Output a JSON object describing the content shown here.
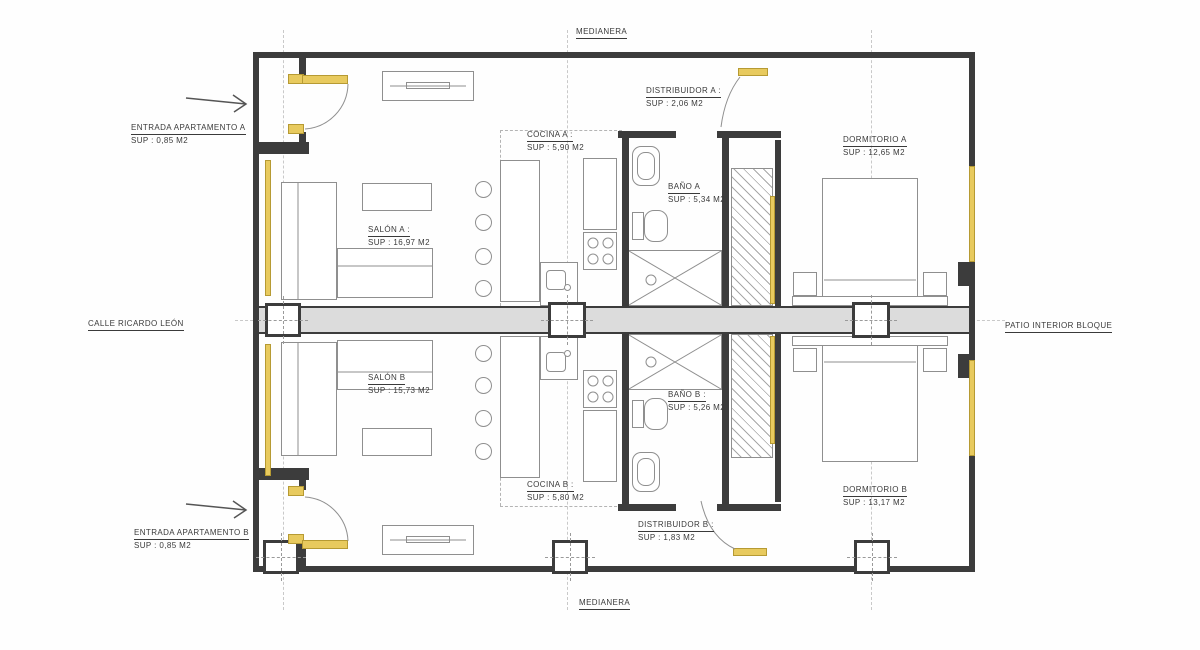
{
  "plan": {
    "boundary_labels": {
      "top": "MEDIANERA",
      "bottom": "MEDIANERA",
      "left": "CALLE RICARDO LEÓN",
      "right": "PATIO INTERIOR BLOQUE"
    },
    "rooms": [
      {
        "id": "entrada-a",
        "name": "ENTRADA APARTAMENTO A",
        "area": "SUP : 0,85 M2"
      },
      {
        "id": "salon-a",
        "name": "SALÓN A :",
        "area": "SUP : 16,97 M2"
      },
      {
        "id": "cocina-a",
        "name": "COCINA A :",
        "area": "SUP : 5,90 M2"
      },
      {
        "id": "bano-a",
        "name": "BAÑO A",
        "area": "SUP : 5,34 M2"
      },
      {
        "id": "distribuidor-a",
        "name": "DISTRIBUIDOR A :",
        "area": "SUP : 2,06 M2"
      },
      {
        "id": "dormitorio-a",
        "name": "DORMITORIO A",
        "area": "SUP : 12,65 M2"
      },
      {
        "id": "entrada-b",
        "name": "ENTRADA APARTAMENTO B",
        "area": "SUP : 0,85 M2"
      },
      {
        "id": "salon-b",
        "name": "SALÓN B",
        "area": "SUP : 15,73 M2"
      },
      {
        "id": "cocina-b",
        "name": "COCINA B :",
        "area": "SUP : 5,80 M2"
      },
      {
        "id": "bano-b",
        "name": "BAÑO B :",
        "area": "SUP : 5,26 M2"
      },
      {
        "id": "distribuidor-b",
        "name": "DISTRIBUIDOR B :",
        "area": "SUP : 1,83 M2"
      },
      {
        "id": "dormitorio-b",
        "name": "DORMITORIO B",
        "area": "SUP : 13,17 M2"
      }
    ],
    "colors": {
      "wall": "#3c3c3c",
      "carpentry": "#e8ca5e",
      "party_wall_fill": "#dcdcdc",
      "furniture_line": "#8f8f8f"
    }
  }
}
